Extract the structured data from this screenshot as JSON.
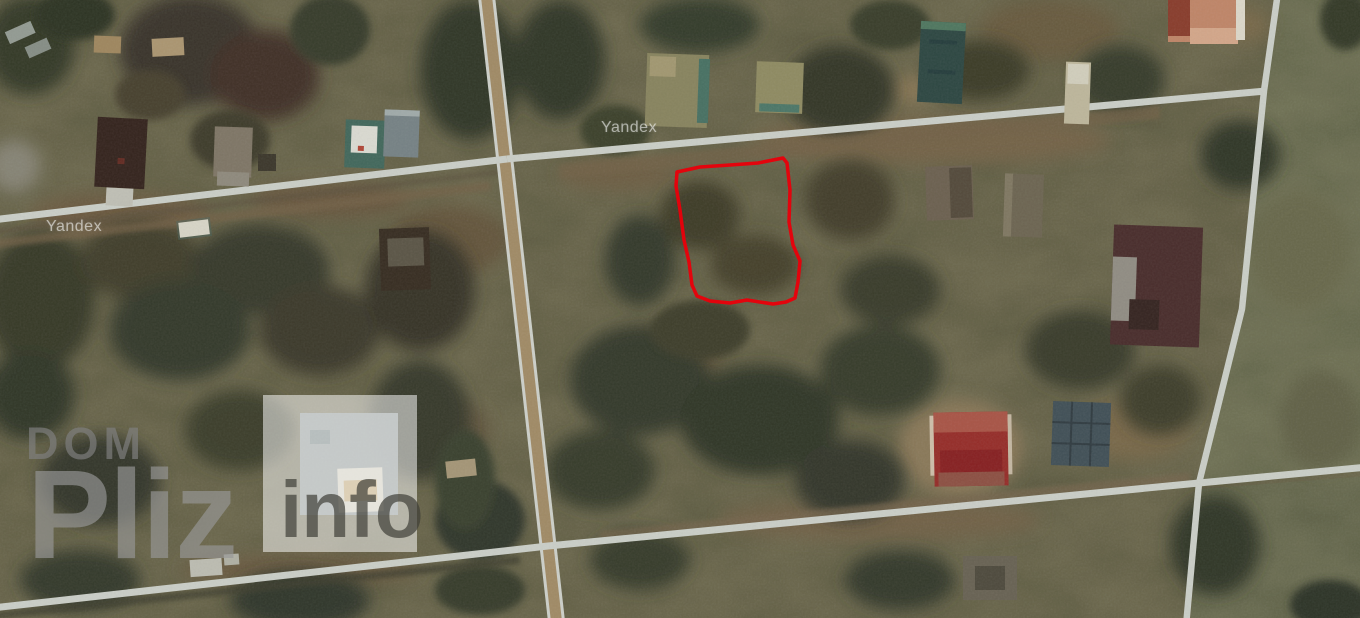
{
  "map": {
    "type": "satellite",
    "provider": "Yandex",
    "watermarks": {
      "yandex_left": "Yandex",
      "yandex_center": "Yandex"
    },
    "site_watermark": {
      "dom": "DOM",
      "pliz": "Pliz",
      "info": "info"
    },
    "plot_outline": {
      "color": "#e8000a",
      "stroke_width": 3.5,
      "points": [
        [
          677,
          172
        ],
        [
          700,
          167
        ],
        [
          730,
          165
        ],
        [
          758,
          163
        ],
        [
          783,
          158
        ],
        [
          787,
          163
        ],
        [
          790,
          190
        ],
        [
          789,
          222
        ],
        [
          793,
          245
        ],
        [
          800,
          261
        ],
        [
          798,
          282
        ],
        [
          795,
          298
        ],
        [
          786,
          302
        ],
        [
          773,
          304
        ],
        [
          747,
          300
        ],
        [
          730,
          303
        ],
        [
          710,
          301
        ],
        [
          697,
          296
        ],
        [
          692,
          285
        ],
        [
          689,
          262
        ],
        [
          684,
          240
        ],
        [
          680,
          210
        ],
        [
          676,
          186
        ]
      ]
    },
    "colors": {
      "road": "#d5d9d4",
      "dirt_road": "#a8906a",
      "field": "#5c6045",
      "field_lower": "#54583f",
      "vegetation_dark": "#31372a",
      "plot_red": "#e8000a",
      "red_roof": "#9c2a28",
      "maroon_roof": "#492a2b",
      "orange_roof": "#c98a6c",
      "teal_roof": "#2a4643"
    }
  }
}
